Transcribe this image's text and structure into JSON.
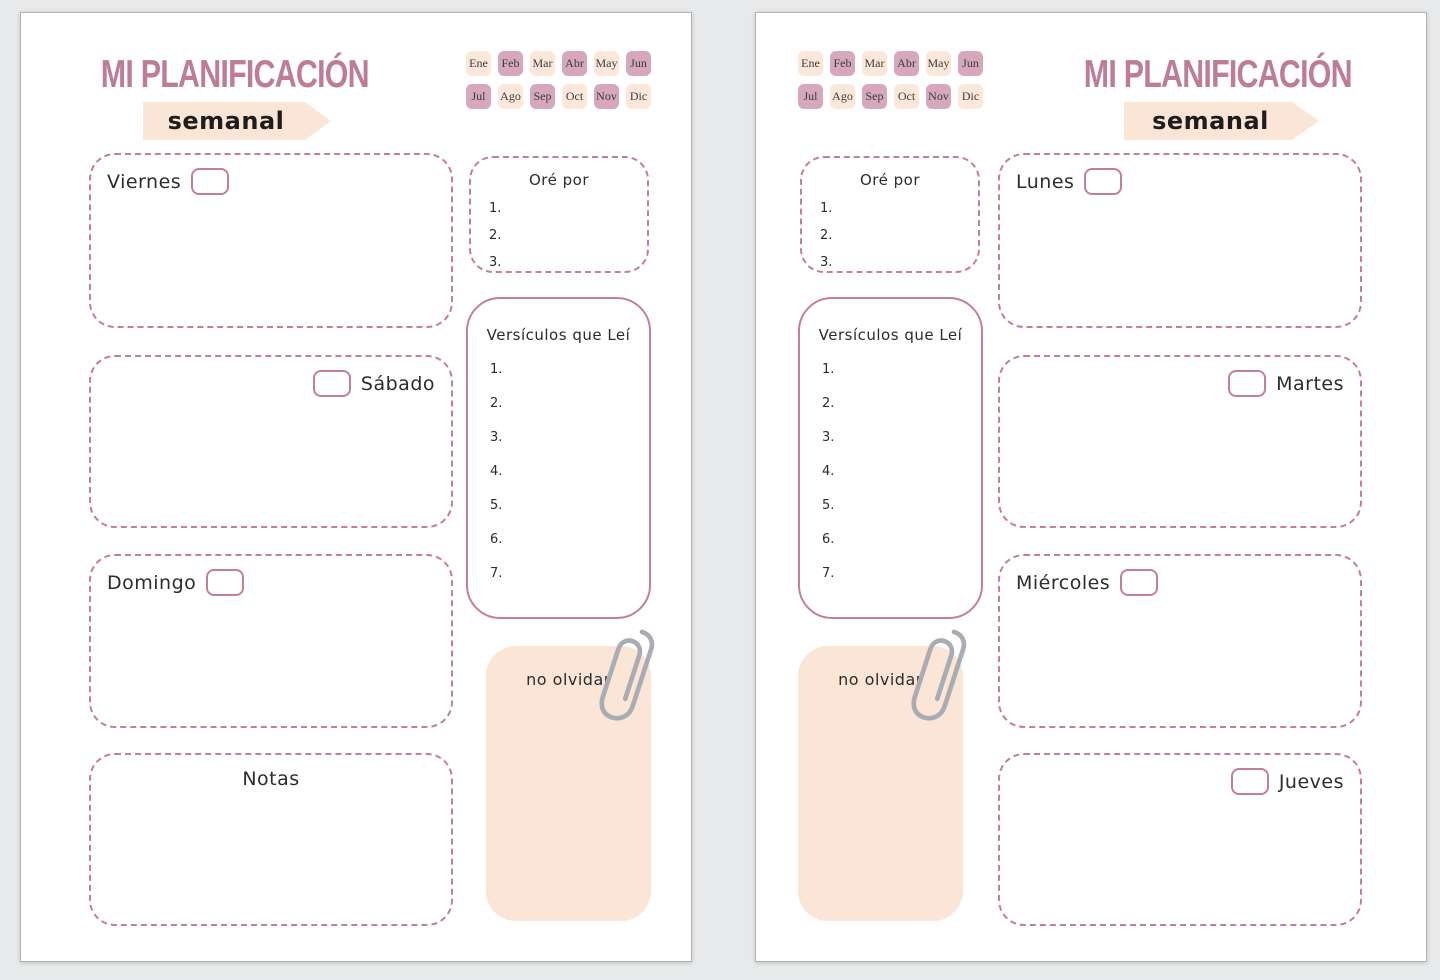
{
  "colors": {
    "background": "#e8e9ea",
    "page-bg": "#ffffff",
    "page-border": "#b3b3b3",
    "title-pink": "#bd7c98",
    "banner-peach": "#fae5d6",
    "chip-peach": "#fbe8da",
    "chip-mauve": "#d7a7bc",
    "dash-rose": "#c57f93",
    "ink": "#2c2c2c",
    "month-ink": "#3c3c3c",
    "paperclip": "#a9adb3"
  },
  "shared": {
    "title": "MI PLANIFICACIÓN",
    "subtitle": "semanal",
    "months": [
      {
        "label": "Ene",
        "tone": "peach"
      },
      {
        "label": "Feb",
        "tone": "mauve"
      },
      {
        "label": "Mar",
        "tone": "peach"
      },
      {
        "label": "Abr",
        "tone": "mauve"
      },
      {
        "label": "May",
        "tone": "peach"
      },
      {
        "label": "Jun",
        "tone": "mauve"
      },
      {
        "label": "Jul",
        "tone": "mauve"
      },
      {
        "label": "Ago",
        "tone": "peach"
      },
      {
        "label": "Sep",
        "tone": "mauve"
      },
      {
        "label": "Oct",
        "tone": "peach"
      },
      {
        "label": "Nov",
        "tone": "mauve"
      },
      {
        "label": "Dic",
        "tone": "peach"
      }
    ],
    "pray_title": "Oré por",
    "pray_items": [
      "1.",
      "2.",
      "3."
    ],
    "verses_title": "Versículos que Leí",
    "verses_items": [
      "1.",
      "2.",
      "3.",
      "4.",
      "5.",
      "6.",
      "7."
    ],
    "reminder_label": "no olvidar"
  },
  "left_page": {
    "days": [
      {
        "label": "Viernes"
      },
      {
        "label": "Sábado"
      },
      {
        "label": "Domingo"
      },
      {
        "label": "Notas"
      }
    ]
  },
  "right_page": {
    "days": [
      {
        "label": "Lunes"
      },
      {
        "label": "Martes"
      },
      {
        "label": "Miércoles"
      },
      {
        "label": "Jueves"
      }
    ]
  }
}
